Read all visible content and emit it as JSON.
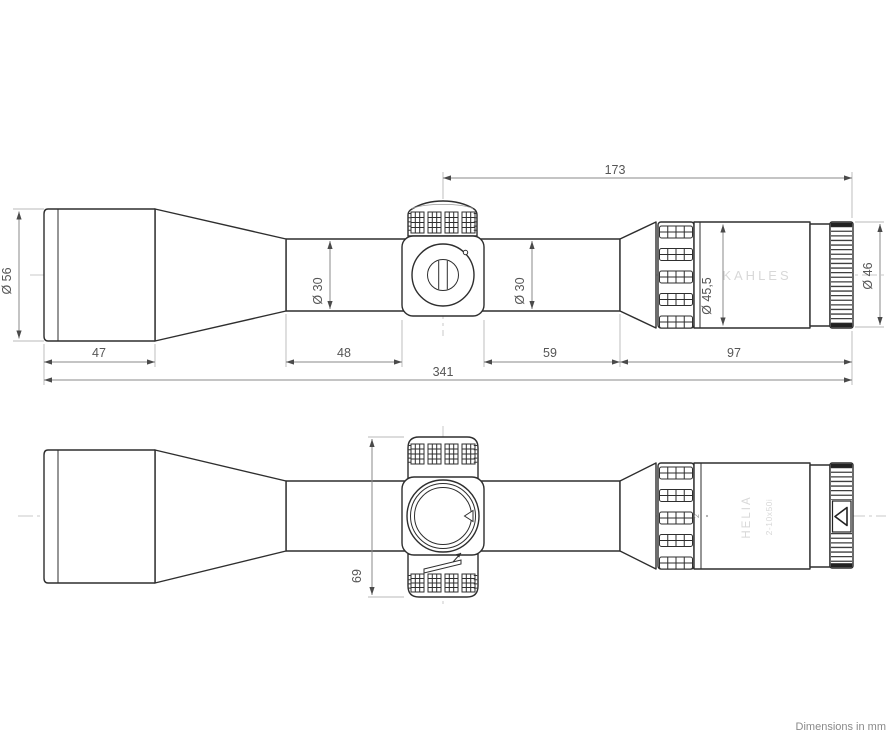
{
  "note": "Dimensions in mm",
  "branding": {
    "maker": "KAHLES",
    "model": "HELIA",
    "spec": "2-10x50i",
    "zoom_index": "2"
  },
  "dims": {
    "total": "341",
    "objective": "47",
    "tube_front": "48",
    "tube_rear": "59",
    "eyepiece": "97",
    "rear": "173",
    "turrets": "69",
    "dia_objective": "Ø 56",
    "dia_tube_front": "Ø 30",
    "dia_tube_rear": "Ø 30",
    "dia_eyepiece": "Ø 45,5",
    "dia_eyering": "Ø 46"
  },
  "colors": {
    "outline": "#2e2e2e",
    "dimension_line": "#8a8a8a",
    "dimension_text": "#565656",
    "brand_text": "#d8d8d8",
    "centerline": "#c9c9c9",
    "background": "#ffffff"
  }
}
